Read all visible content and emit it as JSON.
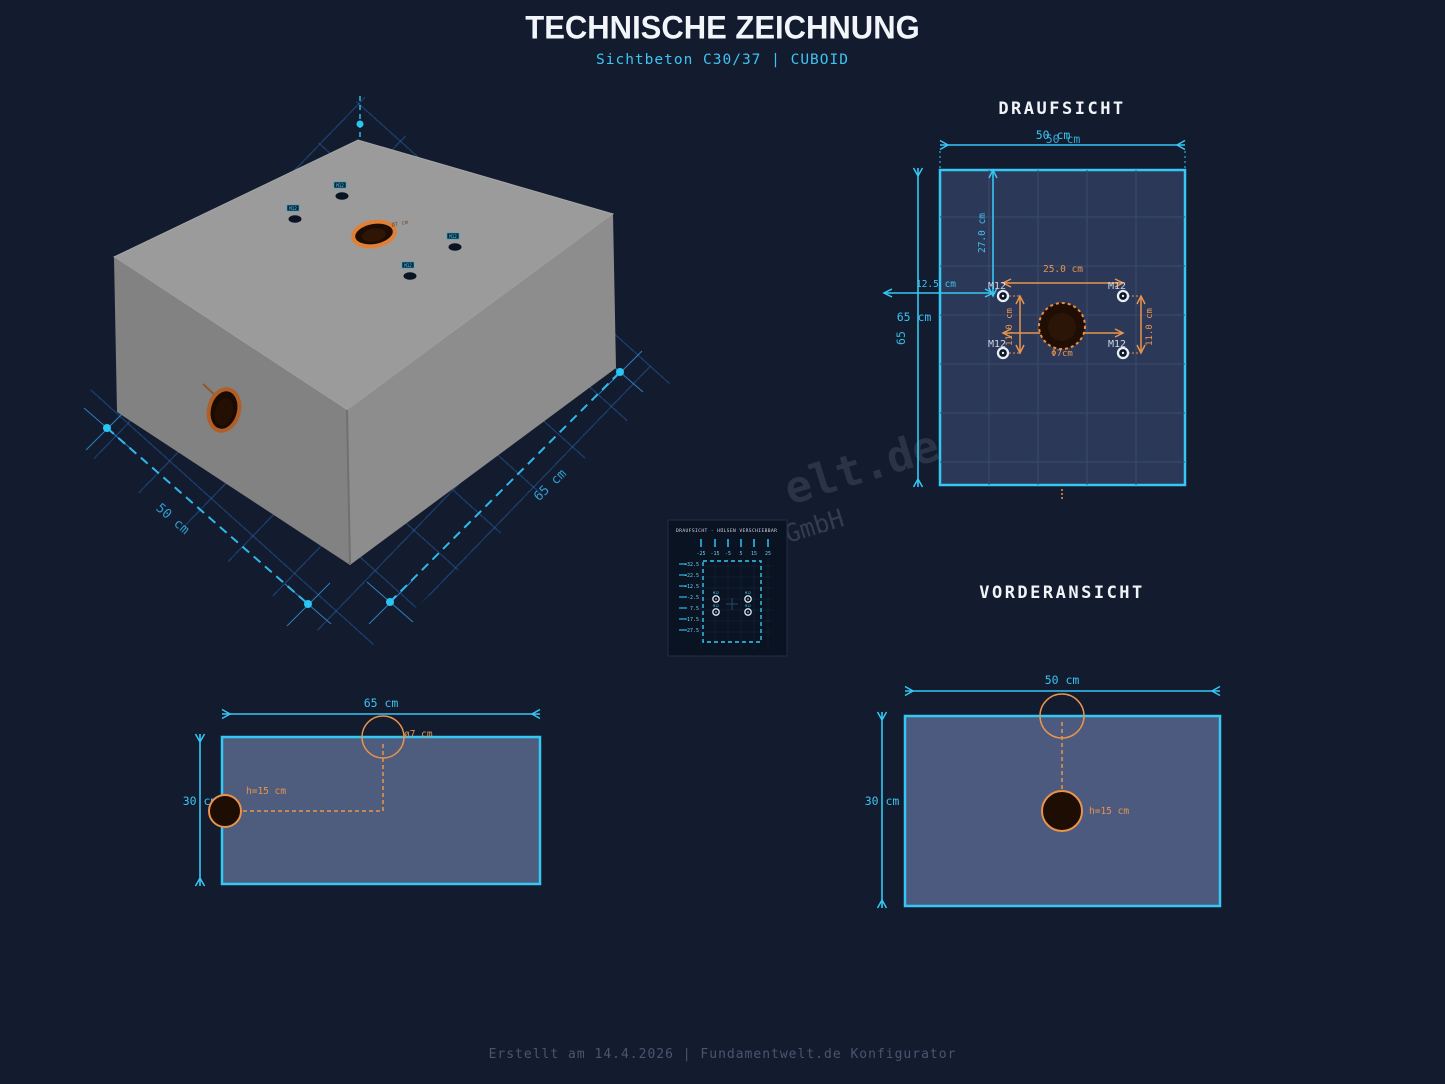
{
  "title": "TECHNISCHE ZEICHNUNG",
  "subtitle": "Sichtbeton C30/37 | CUBOID",
  "footer": "Erstellt am 14.4.2026 | Fundamentwelt.de Konfigurator",
  "watermark": {
    "line1": "elt.de",
    "line2": "GmbH"
  },
  "colors": {
    "background": "#131b2e",
    "accent_cyan": "#35c8f5",
    "accent_orange": "#e8944c",
    "draufsicht_fill": "#2c3857",
    "view_fill": "#4b5a7e",
    "concrete_grey": "#9b9b9b",
    "hole_dark": "#1e0d03"
  },
  "iso": {
    "dim_depth": "50 cm",
    "dim_width": "65 cm",
    "hole_label": "Ø7 cm",
    "sleeve_label": "M12"
  },
  "draufsicht": {
    "title": "DRAUFSICHT",
    "dim_top": "50 cm",
    "dim_left": "65 cm",
    "dim_left_rotated": "65",
    "offset_y": "27.0 cm",
    "offset_x": "12.5 cm",
    "pattern_width": "25.0 cm",
    "pattern_height": "11.0 cm",
    "anchor_label": "M12",
    "hole_label": "Φ7cm"
  },
  "inset": {
    "title": "DRAUFSICHT - HÜLSEN VERSCHIEBBAR",
    "x_ticks": [
      "-25",
      "-15",
      "-5",
      "5",
      "15",
      "25"
    ],
    "y_ticks": [
      "-32.5",
      "-22.5",
      "-12.5",
      "-2.5",
      "7.5",
      "17.5",
      "27.5"
    ],
    "sleeve_label": "M12"
  },
  "seitenansicht": {
    "dim_top": "65 cm",
    "dim_left": "30 cm",
    "hole_diameter": "ø7 cm",
    "hole_height": "h=15 cm"
  },
  "vorderansicht": {
    "title": "VORDERANSICHT",
    "dim_top": "50 cm",
    "dim_left": "30 cm",
    "hole_height": "h=15 cm"
  }
}
